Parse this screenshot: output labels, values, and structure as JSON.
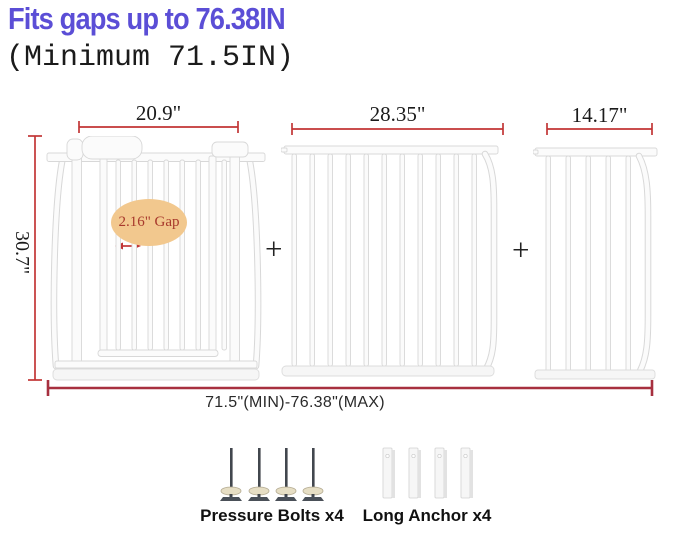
{
  "header": {
    "title": "Fits gaps up to 76.38IN",
    "subtitle": "(Minimum 71.5IN)"
  },
  "diagram": {
    "height_label": "30.7\"",
    "gap_label": "2.16\" Gap",
    "plus_sign": "+",
    "panels": [
      {
        "id": "gate-door-panel",
        "width_label": "20.9\""
      },
      {
        "id": "extension-panel-large",
        "width_label": "28.35\""
      },
      {
        "id": "extension-panel-small",
        "width_label": "14.17\""
      }
    ],
    "total_width_label": "71.5\"(MIN)-76.38\"(MAX)"
  },
  "accessories": [
    {
      "id": "pressure-bolts",
      "label": "Pressure Bolts x4",
      "count": 4
    },
    {
      "id": "long-anchors",
      "label": "Long Anchor x4",
      "count": 4
    }
  ],
  "colors": {
    "title": "#5b4ed6",
    "text": "#1b1b1b",
    "dimension": "#c23535",
    "dimension_dark": "#a7303f",
    "gap_bg": "#f2c88e",
    "gap_text": "#a8392c",
    "gate_outline": "#d8d8d8",
    "gate_fill": "#fbfbfb"
  }
}
